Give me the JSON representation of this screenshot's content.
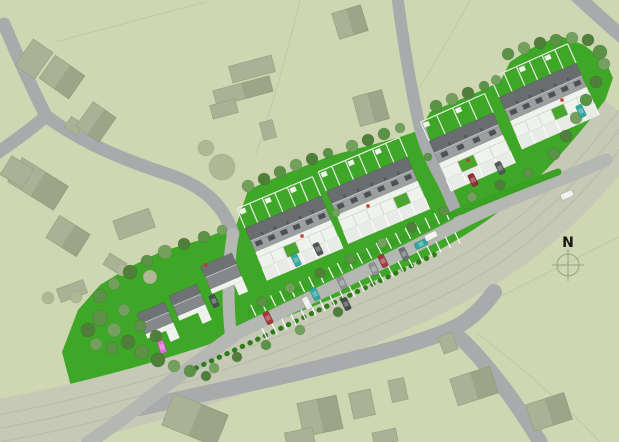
{
  "north": {
    "label": "N",
    "x": 568,
    "y": 265,
    "r": 11
  },
  "colors": {
    "bg": "#ced7b1",
    "parcel": "#c2cda4",
    "site_green": "#3fa727",
    "band": "#c6c9b6",
    "band_line": "#b7bda7",
    "road": "#a8aaac",
    "street": "#b5b7b3",
    "verge": "#3ba125",
    "hedge": "#2e7d18",
    "tick": "#ffffff",
    "bld_fill": "#a9b294",
    "bld_stroke": "#99a385",
    "roof_back": "#6a6d6f",
    "roof_front": "#9c9ea0",
    "roof_ridge": "#c7c8ca",
    "dormer": "#4e5154",
    "chimney": "#53565a",
    "white": "#f0f2ed",
    "court": "#e9ebe6",
    "court_line": "#ffffff",
    "garden_line": "#e9ece6",
    "det_roof_back": "#6f7275",
    "det_roof_front": "#85888b",
    "bg_tree": "#aeb894",
    "tree_palette": [
      "#86a871",
      "#74a05e",
      "#5b9245",
      "#507f3c"
    ],
    "rooflight": "#c03a28",
    "compass": "#9aa089"
  },
  "site": {
    "polygon": "62,352 78,310 100,285 128,268 160,252 200,240 236,226 248,190 270,180 300,168 330,156 352,150 375,144 400,137 420,130 430,112 452,103 478,92 500,82 510,62 528,50 545,42 560,36 584,45 606,62 613,78 601,112 585,142 567,162 540,184 510,208 480,230 450,250 420,270 390,287 362,302 332,317 300,332 268,345 240,354 212,364 184,374 154,388 124,406 102,422 90,430 74,398"
  },
  "railway": {
    "path": "M-10,430 C140,404 290,352 420,292 C505,252 560,208 628,118",
    "width": 58,
    "lines": [
      "M-14,417 C136,391 286,339 416,279 C501,239 556,195 622,106",
      "M-10,430 C140,404 290,352 420,292 C505,252 560,208 628,118",
      "M-6,443 C144,417 294,365 424,305 C509,265 564,221 634,131"
    ]
  },
  "parcel_lines": [
    "M300,0 C286,58 271,110 256,154",
    "M470,0 C452,34 433,66 414,96",
    "M55,42 L205,2",
    "M450,322 L619,237",
    "M478,334 C540,382 578,418 600,442"
  ],
  "roads": [
    {
      "d": "M4,24 C18,58 32,88 46,116",
      "w": 13
    },
    {
      "d": "M46,116 C30,130 12,143 -6,155",
      "w": 13
    },
    {
      "d": "M46,116 C85,145 130,162 170,175 C205,187 224,206 233,234",
      "w": 13
    },
    {
      "d": "M397,-6 C403,40 410,85 420,128 C426,150 434,166 444,184 C449,195 453,204 456,213",
      "w": 12
    },
    {
      "d": "M575,-6 C591,9 606,23 624,38",
      "w": 14
    },
    {
      "d": "M140,408 C210,392 280,378 350,360 C395,349 432,339 458,326 C472,318 484,306 494,292",
      "w": 16
    },
    {
      "d": "M452,331 C478,352 512,395 540,442",
      "w": 15
    }
  ],
  "streets": [
    {
      "d": "M233,234 C228,262 227,300 231,336",
      "w": 12
    },
    {
      "d": "M233,336 C206,356 172,380 138,407 C120,421 104,432 88,443",
      "w": 14
    },
    {
      "d": "M231,336 C310,298 390,260 462,222 C510,198 552,184 606,160",
      "w": 13
    }
  ],
  "verge": {
    "d": "M250,312 C320,278 390,243 458,212 C494,197 524,185 558,172",
    "w": 7
  },
  "hedge": {
    "d": "M196,368 C270,334 352,294 440,252",
    "w": 5
  },
  "parking": {
    "points": [
      [
        231,
        336
      ],
      [
        259,
        322
      ],
      [
        288,
        308
      ],
      [
        317,
        294
      ],
      [
        346,
        280
      ],
      [
        375,
        265
      ],
      [
        404,
        250
      ],
      [
        433,
        235
      ],
      [
        461,
        222
      ],
      [
        489,
        209
      ]
    ],
    "from": 1,
    "to": 8,
    "inner": 7,
    "outer": 19
  },
  "terraces": [
    {
      "cx": 288,
      "cy": 224,
      "angle": -23,
      "len": 82,
      "depth": 26,
      "units": 6,
      "green_unit": 2
    },
    {
      "cx": 372,
      "cy": 186,
      "angle": -23,
      "len": 88,
      "depth": 26,
      "units": 6,
      "green_unit": 4
    },
    {
      "cx": 466,
      "cy": 138,
      "angle": -24,
      "len": 70,
      "depth": 24,
      "units": 4,
      "green_unit": 1
    },
    {
      "cx": 543,
      "cy": 92,
      "angle": -24,
      "len": 84,
      "depth": 26,
      "units": 6,
      "green_unit": 3
    }
  ],
  "detached_houses": [
    {
      "cx": 155,
      "cy": 318,
      "w": 30,
      "h": 22,
      "angle": -23
    },
    {
      "cx": 187,
      "cy": 300,
      "w": 30,
      "h": 22,
      "angle": -23
    },
    {
      "cx": 221,
      "cy": 271,
      "w": 34,
      "h": 25,
      "angle": -23
    }
  ],
  "existing_buildings": [
    {
      "cx": 34,
      "cy": 59,
      "w": 24,
      "h": 32,
      "a": 35,
      "shade": 0
    },
    {
      "cx": 62,
      "cy": 77,
      "w": 36,
      "h": 28,
      "a": 35,
      "shade": 1
    },
    {
      "cx": 74,
      "cy": 126,
      "w": 15,
      "h": 13,
      "a": 35,
      "shade": 0
    },
    {
      "cx": 96,
      "cy": 122,
      "w": 28,
      "h": 30,
      "a": 35,
      "shade": 1
    },
    {
      "cx": 252,
      "cy": 69,
      "w": 44,
      "h": 17,
      "a": -15,
      "shade": 0
    },
    {
      "cx": 243,
      "cy": 91,
      "w": 58,
      "h": 16,
      "a": -15,
      "shade": 1
    },
    {
      "cx": 224,
      "cy": 109,
      "w": 26,
      "h": 14,
      "a": -15,
      "shade": 0
    },
    {
      "cx": 268,
      "cy": 130,
      "w": 13,
      "h": 18,
      "a": -15,
      "shade": 0
    },
    {
      "cx": 350,
      "cy": 22,
      "w": 30,
      "h": 27,
      "a": -17,
      "shade": 1
    },
    {
      "cx": 371,
      "cy": 108,
      "w": 30,
      "h": 30,
      "a": -15,
      "shade": 1
    },
    {
      "cx": 38,
      "cy": 184,
      "w": 54,
      "h": 28,
      "a": 32,
      "shade": 1
    },
    {
      "cx": 17,
      "cy": 172,
      "w": 26,
      "h": 22,
      "a": 32,
      "shade": 0
    },
    {
      "cx": 68,
      "cy": 236,
      "w": 36,
      "h": 26,
      "a": 32,
      "shade": 1
    },
    {
      "cx": 115,
      "cy": 264,
      "w": 20,
      "h": 13,
      "a": 32,
      "shade": 0
    },
    {
      "cx": 134,
      "cy": 224,
      "w": 38,
      "h": 20,
      "a": -20,
      "shade": 0
    },
    {
      "cx": 72,
      "cy": 291,
      "w": 28,
      "h": 14,
      "a": -20,
      "shade": 0
    },
    {
      "cx": 195,
      "cy": 420,
      "w": 58,
      "h": 34,
      "a": 22,
      "shade": 1
    },
    {
      "cx": 320,
      "cy": 416,
      "w": 40,
      "h": 34,
      "a": -12,
      "shade": 1
    },
    {
      "cx": 362,
      "cy": 404,
      "w": 22,
      "h": 26,
      "a": -12,
      "shade": 0
    },
    {
      "cx": 398,
      "cy": 390,
      "w": 16,
      "h": 22,
      "a": -12,
      "shade": 0
    },
    {
      "cx": 300,
      "cy": 439,
      "w": 28,
      "h": 18,
      "a": -12,
      "shade": 0
    },
    {
      "cx": 385,
      "cy": 437,
      "w": 24,
      "h": 13,
      "a": -12,
      "shade": 0
    },
    {
      "cx": 474,
      "cy": 386,
      "w": 42,
      "h": 28,
      "a": -18,
      "shade": 1
    },
    {
      "cx": 549,
      "cy": 412,
      "w": 40,
      "h": 28,
      "a": -18,
      "shade": 1
    },
    {
      "cx": 448,
      "cy": 343,
      "w": 15,
      "h": 18,
      "a": -20,
      "shade": 0
    }
  ],
  "bg_trees": [
    [
      222,
      167,
      13
    ],
    [
      206,
      148,
      8
    ],
    [
      150,
      277,
      7
    ],
    [
      122,
      270,
      6
    ],
    [
      48,
      298,
      6
    ],
    [
      76,
      297,
      6
    ]
  ],
  "trees": [
    [
      100,
      296,
      7,
      2
    ],
    [
      114,
      284,
      6,
      1
    ],
    [
      130,
      272,
      7,
      3
    ],
    [
      147,
      261,
      6,
      2
    ],
    [
      165,
      252,
      7,
      1
    ],
    [
      184,
      244,
      6,
      3
    ],
    [
      204,
      237,
      6,
      2
    ],
    [
      222,
      230,
      5,
      1
    ],
    [
      248,
      186,
      6,
      1
    ],
    [
      264,
      179,
      6,
      3
    ],
    [
      280,
      172,
      6,
      2
    ],
    [
      296,
      165,
      6,
      1
    ],
    [
      312,
      159,
      6,
      3
    ],
    [
      328,
      153,
      5,
      2
    ],
    [
      352,
      146,
      6,
      1
    ],
    [
      368,
      140,
      6,
      3
    ],
    [
      384,
      134,
      6,
      2
    ],
    [
      400,
      128,
      5,
      1
    ],
    [
      436,
      106,
      6,
      2
    ],
    [
      452,
      99,
      6,
      1
    ],
    [
      468,
      93,
      6,
      3
    ],
    [
      484,
      86,
      5,
      2
    ],
    [
      496,
      80,
      5,
      1
    ],
    [
      508,
      54,
      6,
      2
    ],
    [
      524,
      48,
      6,
      1
    ],
    [
      540,
      43,
      6,
      3
    ],
    [
      556,
      40,
      6,
      2
    ],
    [
      572,
      38,
      6,
      1
    ],
    [
      588,
      40,
      6,
      3
    ],
    [
      600,
      52,
      7,
      2
    ],
    [
      604,
      64,
      6,
      1
    ],
    [
      596,
      82,
      6,
      3
    ],
    [
      586,
      100,
      6,
      2
    ],
    [
      576,
      118,
      6,
      1
    ],
    [
      566,
      136,
      6,
      3
    ],
    [
      554,
      154,
      6,
      2
    ],
    [
      88,
      330,
      7,
      3
    ],
    [
      100,
      318,
      8,
      2
    ],
    [
      114,
      330,
      7,
      1
    ],
    [
      128,
      342,
      7,
      3
    ],
    [
      112,
      348,
      6,
      2
    ],
    [
      96,
      344,
      6,
      1
    ],
    [
      142,
      352,
      7,
      2
    ],
    [
      158,
      360,
      7,
      3
    ],
    [
      174,
      366,
      6,
      1
    ],
    [
      140,
      326,
      6,
      2
    ],
    [
      156,
      336,
      6,
      3
    ],
    [
      190,
      371,
      6,
      2
    ],
    [
      206,
      376,
      5,
      3
    ],
    [
      124,
      310,
      6,
      1
    ],
    [
      262,
      302,
      5,
      2
    ],
    [
      290,
      288,
      5,
      1
    ],
    [
      320,
      273,
      5,
      3
    ],
    [
      350,
      259,
      5,
      2
    ],
    [
      382,
      243,
      5,
      1
    ],
    [
      412,
      227,
      5,
      3
    ],
    [
      444,
      211,
      5,
      2
    ],
    [
      472,
      197,
      5,
      1
    ],
    [
      500,
      185,
      5,
      3
    ],
    [
      528,
      173,
      5,
      2
    ],
    [
      336,
      213,
      4,
      1
    ],
    [
      428,
      157,
      4,
      2
    ],
    [
      338,
      312,
      5,
      3
    ],
    [
      300,
      330,
      5,
      1
    ],
    [
      266,
      345,
      5,
      2
    ],
    [
      237,
      357,
      5,
      3
    ],
    [
      214,
      368,
      5,
      1
    ]
  ],
  "cars": [
    [
      162,
      347,
      70,
      "#e26fd8"
    ],
    [
      214,
      301,
      65,
      "#4b4f53"
    ],
    [
      268,
      318,
      64,
      "#a8353c"
    ],
    [
      296,
      260,
      64,
      "#2fa8a0"
    ],
    [
      318,
      249,
      64,
      "#515559"
    ],
    [
      307,
      303,
      64,
      "#eceeec"
    ],
    [
      315,
      294,
      64,
      "#2fa8a0"
    ],
    [
      342,
      283,
      64,
      "#8f9295"
    ],
    [
      346,
      304,
      64,
      "#46494d"
    ],
    [
      374,
      269,
      64,
      "#8f9295"
    ],
    [
      383,
      261,
      64,
      "#a03a40"
    ],
    [
      404,
      254,
      64,
      "#6d7073"
    ],
    [
      421,
      244,
      -26,
      "#2fa8a0"
    ],
    [
      431,
      236,
      -26,
      "#f0f2f2"
    ],
    [
      473,
      180,
      64,
      "#8e3036"
    ],
    [
      500,
      168,
      64,
      "#54575b"
    ],
    [
      567,
      195,
      -24,
      "#eef0ef"
    ],
    [
      581,
      111,
      64,
      "#2fa8a0"
    ]
  ],
  "rooflights": [
    [
      302,
      236
    ],
    [
      368,
      206
    ],
    [
      468,
      160
    ],
    [
      562,
      100
    ],
    [
      206,
      265
    ]
  ]
}
